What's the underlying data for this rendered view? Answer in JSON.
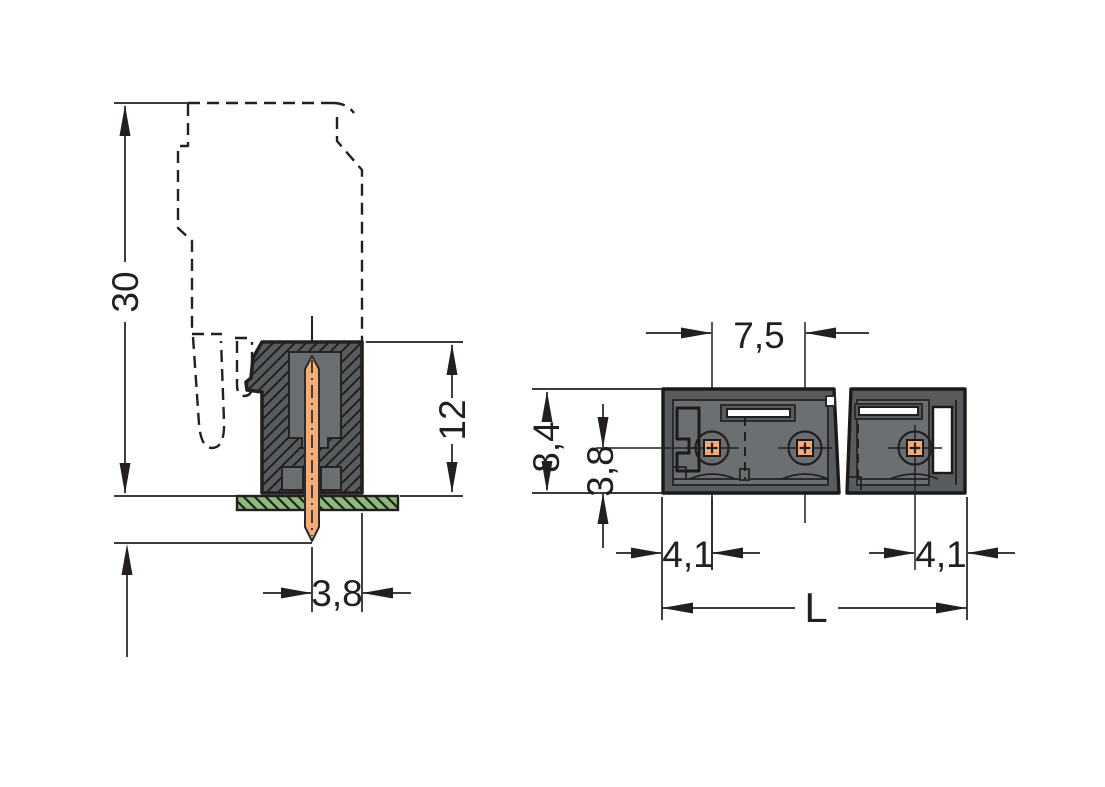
{
  "drawing": {
    "side_view": {
      "labels": {
        "overall_height": "30",
        "height_above_pcb": "12",
        "pin_to_edge": "3,8"
      }
    },
    "top_view": {
      "labels": {
        "pin_pitch": "7,5",
        "body_depth": "8,4",
        "pin_row_to_edge": "3,8",
        "left_end_to_pin": "4,1",
        "right_end_to_pin": "4,1",
        "overall_length": "L"
      }
    }
  },
  "colors": {
    "body": "#585c5f",
    "cavity": "#6b6f72",
    "pin": "#f4ad76",
    "pcb": "#8cba78",
    "line": "#231f20",
    "background": "#ffffff"
  }
}
